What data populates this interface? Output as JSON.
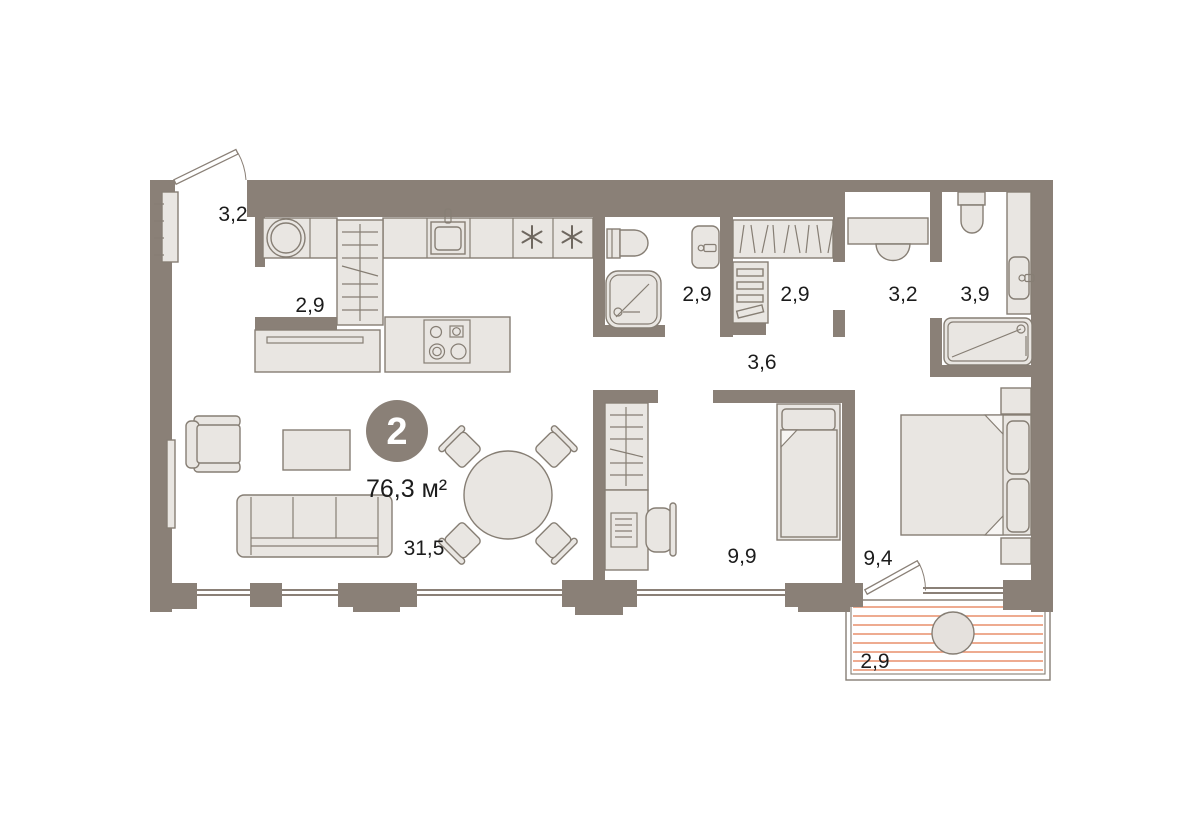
{
  "plan": {
    "badge": {
      "room_count": "2",
      "total_area": "76,3 м²"
    },
    "rooms": [
      {
        "id": "entrance-hall",
        "area": "3,2"
      },
      {
        "id": "closet",
        "area": "2,9"
      },
      {
        "id": "shower-room",
        "area": "2,9"
      },
      {
        "id": "wardrobe",
        "area": "2,9"
      },
      {
        "id": "corridor",
        "area": "3,2"
      },
      {
        "id": "bathroom",
        "area": "3,9"
      },
      {
        "id": "hallway",
        "area": "3,6"
      },
      {
        "id": "living-kitchen",
        "area": "31,5"
      },
      {
        "id": "bedroom",
        "area": "9,9"
      },
      {
        "id": "master-bedroom",
        "area": "9,4"
      },
      {
        "id": "balcony",
        "area": "2,9"
      }
    ],
    "colors": {
      "wall": "#8A8077",
      "furniture_fill": "#E9E6E2",
      "furniture_stroke": "#867E74",
      "balcony_stripe": "#E98F6B",
      "label": "#1C1C1C",
      "background": "#FFFFFF",
      "badge_text": "#FFFFFF"
    }
  }
}
